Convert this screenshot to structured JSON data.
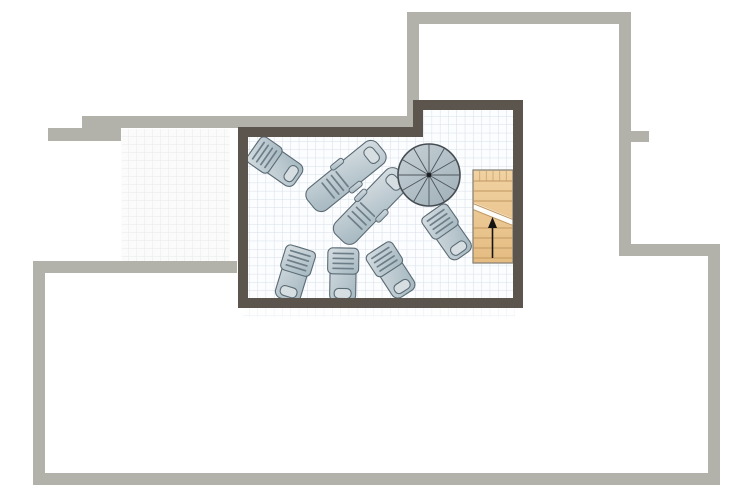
{
  "document": {
    "type": "floor-plan",
    "view": "2d-top-down",
    "rooms": {
      "terrace": "gridded terrace room with dark wall border",
      "left_area": "adjacent faint-grid floor area",
      "lower_area": "large empty walled area"
    }
  },
  "colors": {
    "page_bg": "#ffffff",
    "wall_light": "#b2b2ab",
    "wall_dark": "#5b554e",
    "floor_bg": "#fcfdfe",
    "grid_line": "#d7e0ea",
    "left_floor_bg": "#fbfbfc",
    "left_grid_line": "#e7e9ed",
    "lounger_outline": "#5b6b74",
    "lounger_fill_light": "#d6dee2",
    "lounger_fill_dark": "#a5b7c0",
    "lounger_slat": "#6d7e88",
    "spiral_fill_light": "#c7d1d6",
    "spiral_fill_dark": "#a3b2bb",
    "spiral_outline": "#454d53",
    "spiral_spoke": "#4e565c",
    "spiral_center_dot": "#1b1e21",
    "stairs_fill_light": "#f1d2a2",
    "stairs_fill_dark": "#e5bc82",
    "stairs_tread": "#c09760",
    "stairs_outline": "#8a847a",
    "stairs_break_line": "#c09760",
    "break_band_bg": "#fdfdfc",
    "arrow_color": "#141414"
  },
  "furniture": {
    "loungers": [
      {
        "name": "sun-lounger-1",
        "variant": "short",
        "x": 276,
        "y": 163,
        "rotation": -55
      },
      {
        "name": "sun-lounger-2",
        "variant": "long",
        "x": 346,
        "y": 176,
        "rotation": 51
      },
      {
        "name": "sun-lounger-3",
        "variant": "long",
        "x": 371,
        "y": 206,
        "rotation": 44
      },
      {
        "name": "sun-lounger-4",
        "variant": "short",
        "x": 448,
        "y": 233,
        "rotation": -35
      },
      {
        "name": "sun-lounger-5",
        "variant": "short",
        "x": 294,
        "y": 274,
        "rotation": 17
      },
      {
        "name": "sun-lounger-6",
        "variant": "short",
        "x": 343,
        "y": 275,
        "rotation": 1
      },
      {
        "name": "sun-lounger-7",
        "variant": "short",
        "x": 392,
        "y": 271,
        "rotation": -33
      }
    ],
    "spiral_staircase": {
      "x": 429,
      "y": 175,
      "radius": 31,
      "segments": 12
    },
    "staircase": {
      "x": 473,
      "y": 170,
      "width": 40,
      "height": 93,
      "arrow_direction": "up"
    }
  }
}
